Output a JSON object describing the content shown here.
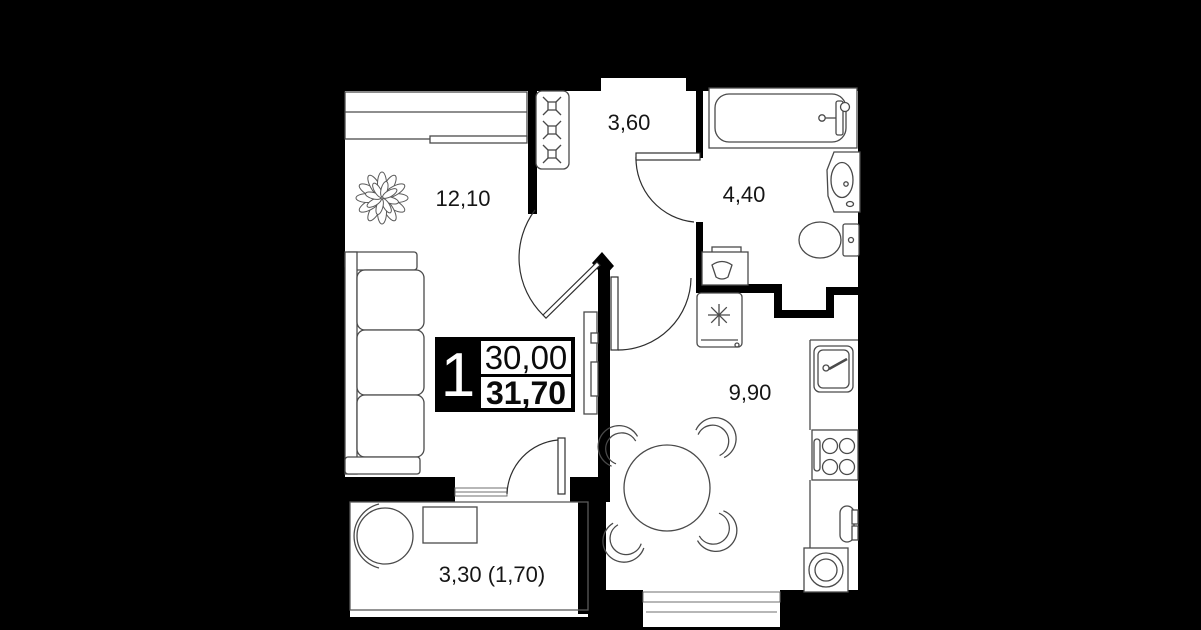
{
  "document": {
    "type": "apartment-floor-plan",
    "plan_name": "1-room apartment"
  },
  "badge": {
    "rooms_count": "1",
    "area_main": "30,00",
    "area_total": "31,70"
  },
  "rooms": {
    "living": {
      "name": "living-room",
      "area": "12,10"
    },
    "hallway": {
      "name": "hallway",
      "area": "3,60"
    },
    "bathroom": {
      "name": "bathroom",
      "area": "4,40"
    },
    "kitchen": {
      "name": "kitchen",
      "area": "9,90"
    },
    "balcony": {
      "name": "balcony",
      "area": "3,30 (1,70)"
    }
  },
  "colors": {
    "background": "#000000",
    "floor": "#ffffff",
    "wall": "#000000",
    "furniture_line": "#4a4a4a",
    "text": "#161616"
  }
}
